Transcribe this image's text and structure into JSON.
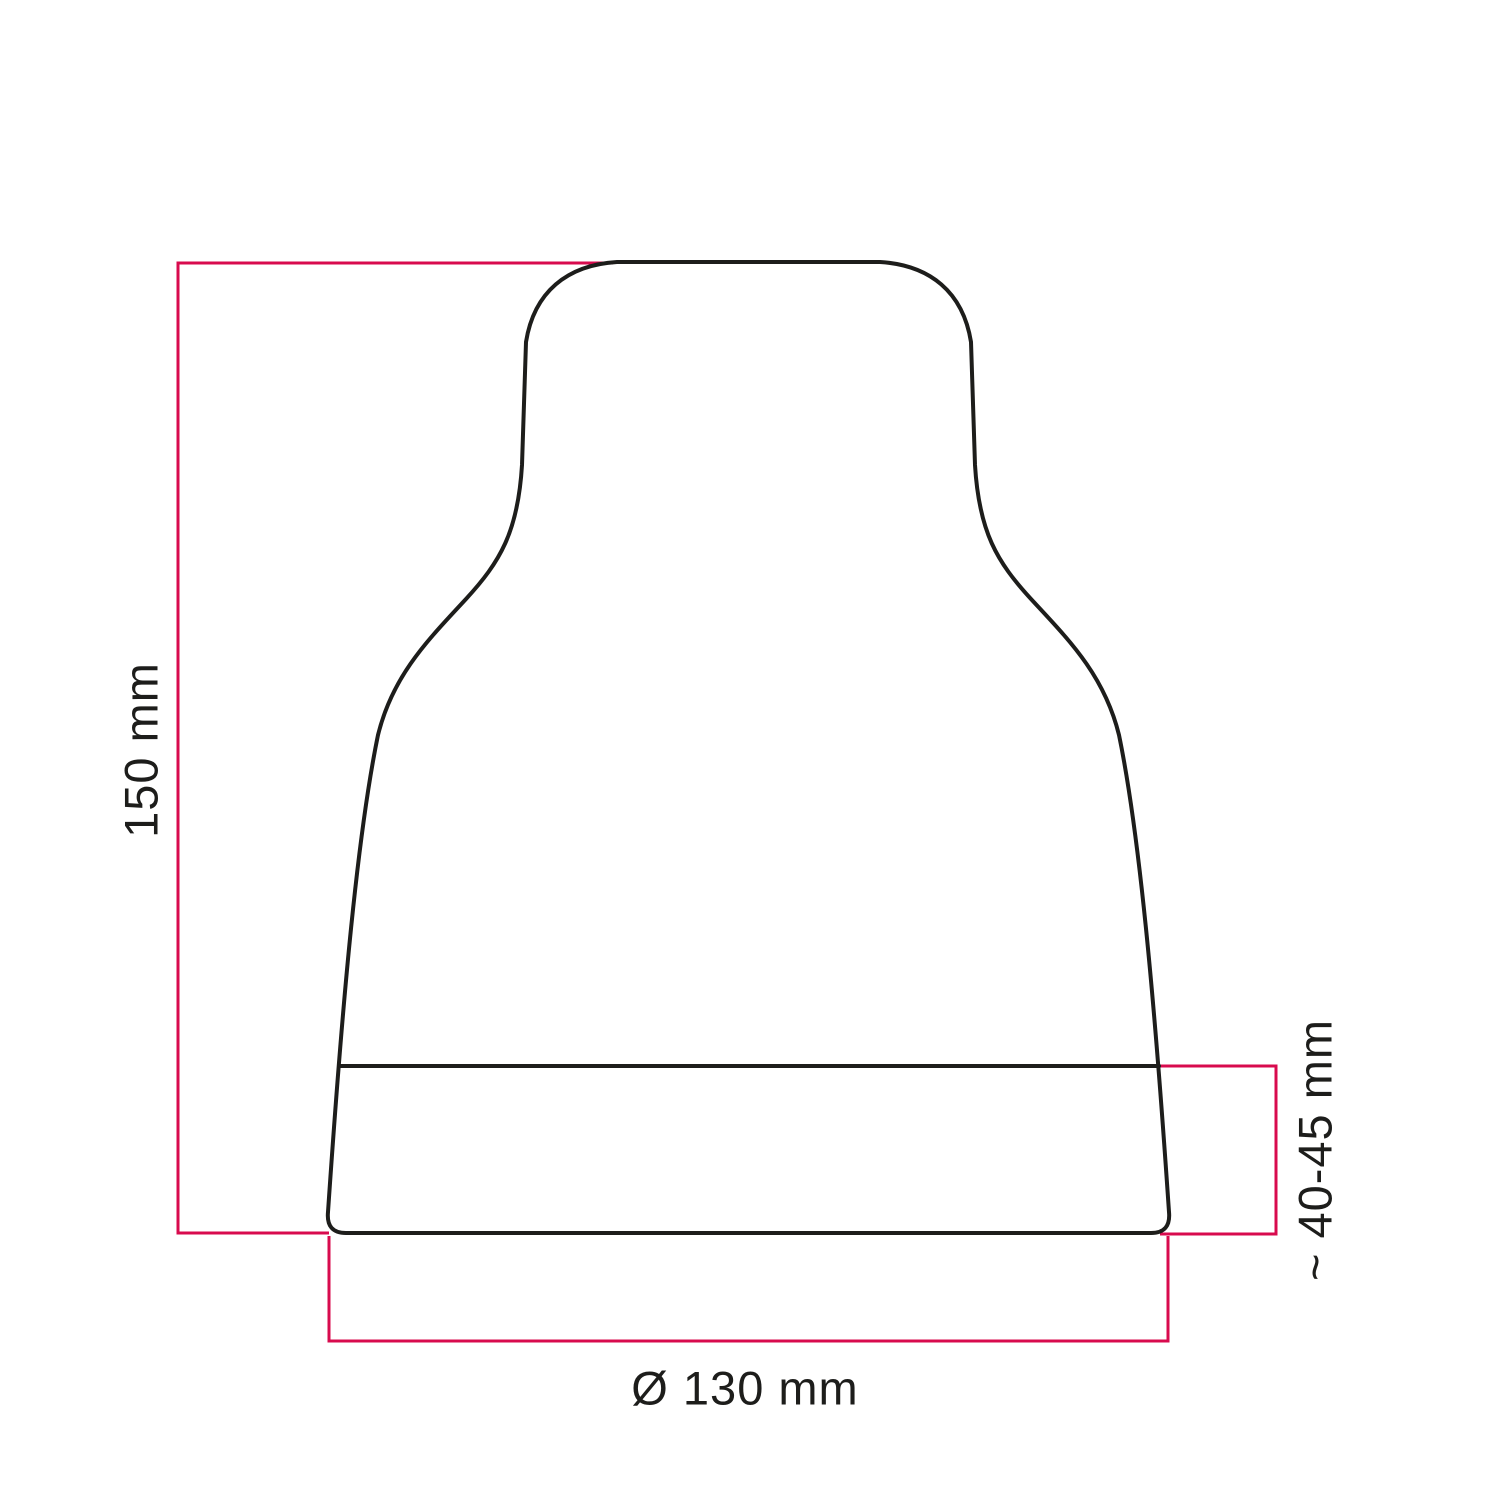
{
  "diagram": {
    "title": "lampshade-dimension-drawing",
    "object": "bell-shaped lampshade silhouette (side view)",
    "dimensions": {
      "height": {
        "label": "150 mm",
        "orientation": "vertical-left"
      },
      "base_height": {
        "label": "~ 40-45 mm",
        "orientation": "vertical-right"
      },
      "diameter": {
        "label": "Ø 130 mm",
        "orientation": "horizontal-bottom"
      }
    },
    "colors": {
      "outline": "#1d1d1b",
      "dimension": "#d80b4e",
      "text": "#1d1d1b",
      "background": "#ffffff"
    }
  }
}
